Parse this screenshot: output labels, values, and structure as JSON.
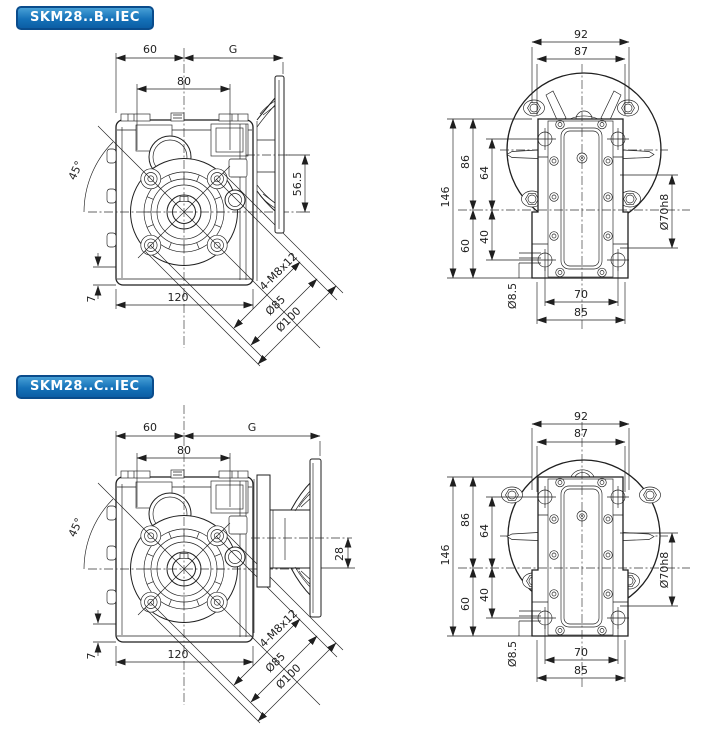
{
  "page": {
    "background": "#ffffff",
    "line_color": "#1f1f1f",
    "badge_color": "#1571b8",
    "badge_border": "#0a4c8c"
  },
  "sections": [
    {
      "badge": "SKM28..B..IEC",
      "axis_offset_dim": "56.5"
    },
    {
      "badge": "SKM28..C..IEC",
      "axis_offset_dim": "28"
    }
  ],
  "side_view": {
    "top_width": "60",
    "motor_dim": "G",
    "hole_span": "80",
    "angle": "45°",
    "foot_height": "7",
    "base_width": "120",
    "tap_note": "4-M8x12",
    "bolt_circle": "Ø85",
    "pilot_dia": "Ø100"
  },
  "front_view": {
    "overall_width": "92",
    "body_width": "87",
    "overall_height": "146",
    "upper_height": "86",
    "lower_height": "60",
    "upper_bolt_height": "64",
    "lower_bolt_height": "40",
    "spigot_dia": "Ø70h8",
    "hole_dia": "Ø8.5",
    "bolt_spacing": "70",
    "foot_width": "85"
  }
}
